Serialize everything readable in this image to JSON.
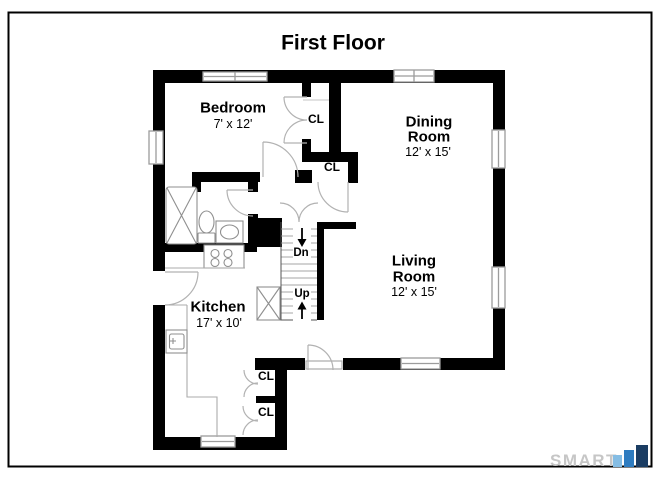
{
  "title": "First Floor",
  "plan": {
    "rooms": {
      "bedroom": {
        "name": "Bedroom",
        "dims": "7' x 12'"
      },
      "dining_room": {
        "line1": "Dining",
        "line2": "Room",
        "dims": "12' x 15'"
      },
      "living_room": {
        "line1": "Living",
        "line2": "Room",
        "dims": "12' x 15'"
      },
      "kitchen": {
        "name": "Kitchen",
        "dims": "17' x 10'"
      }
    },
    "closets": [
      {
        "label": "CL"
      },
      {
        "label": "CL"
      },
      {
        "label": "CL"
      },
      {
        "label": "CL"
      }
    ],
    "stairs": {
      "down": "Dn",
      "up": "Up"
    }
  },
  "branding": {
    "logo_text": "SMART",
    "logo_text_color": "#c6c6c6",
    "bar_colors": [
      "#85bde4",
      "#2e7cc0",
      "#1b3d63"
    ]
  },
  "colors": {
    "wall": "#000000",
    "background": "#ffffff",
    "window_stroke": "#9c9c9c",
    "door_arc": "#b2b2b2",
    "fixture": "#8f8f8f",
    "stair_tread": "#a5a5a5"
  }
}
